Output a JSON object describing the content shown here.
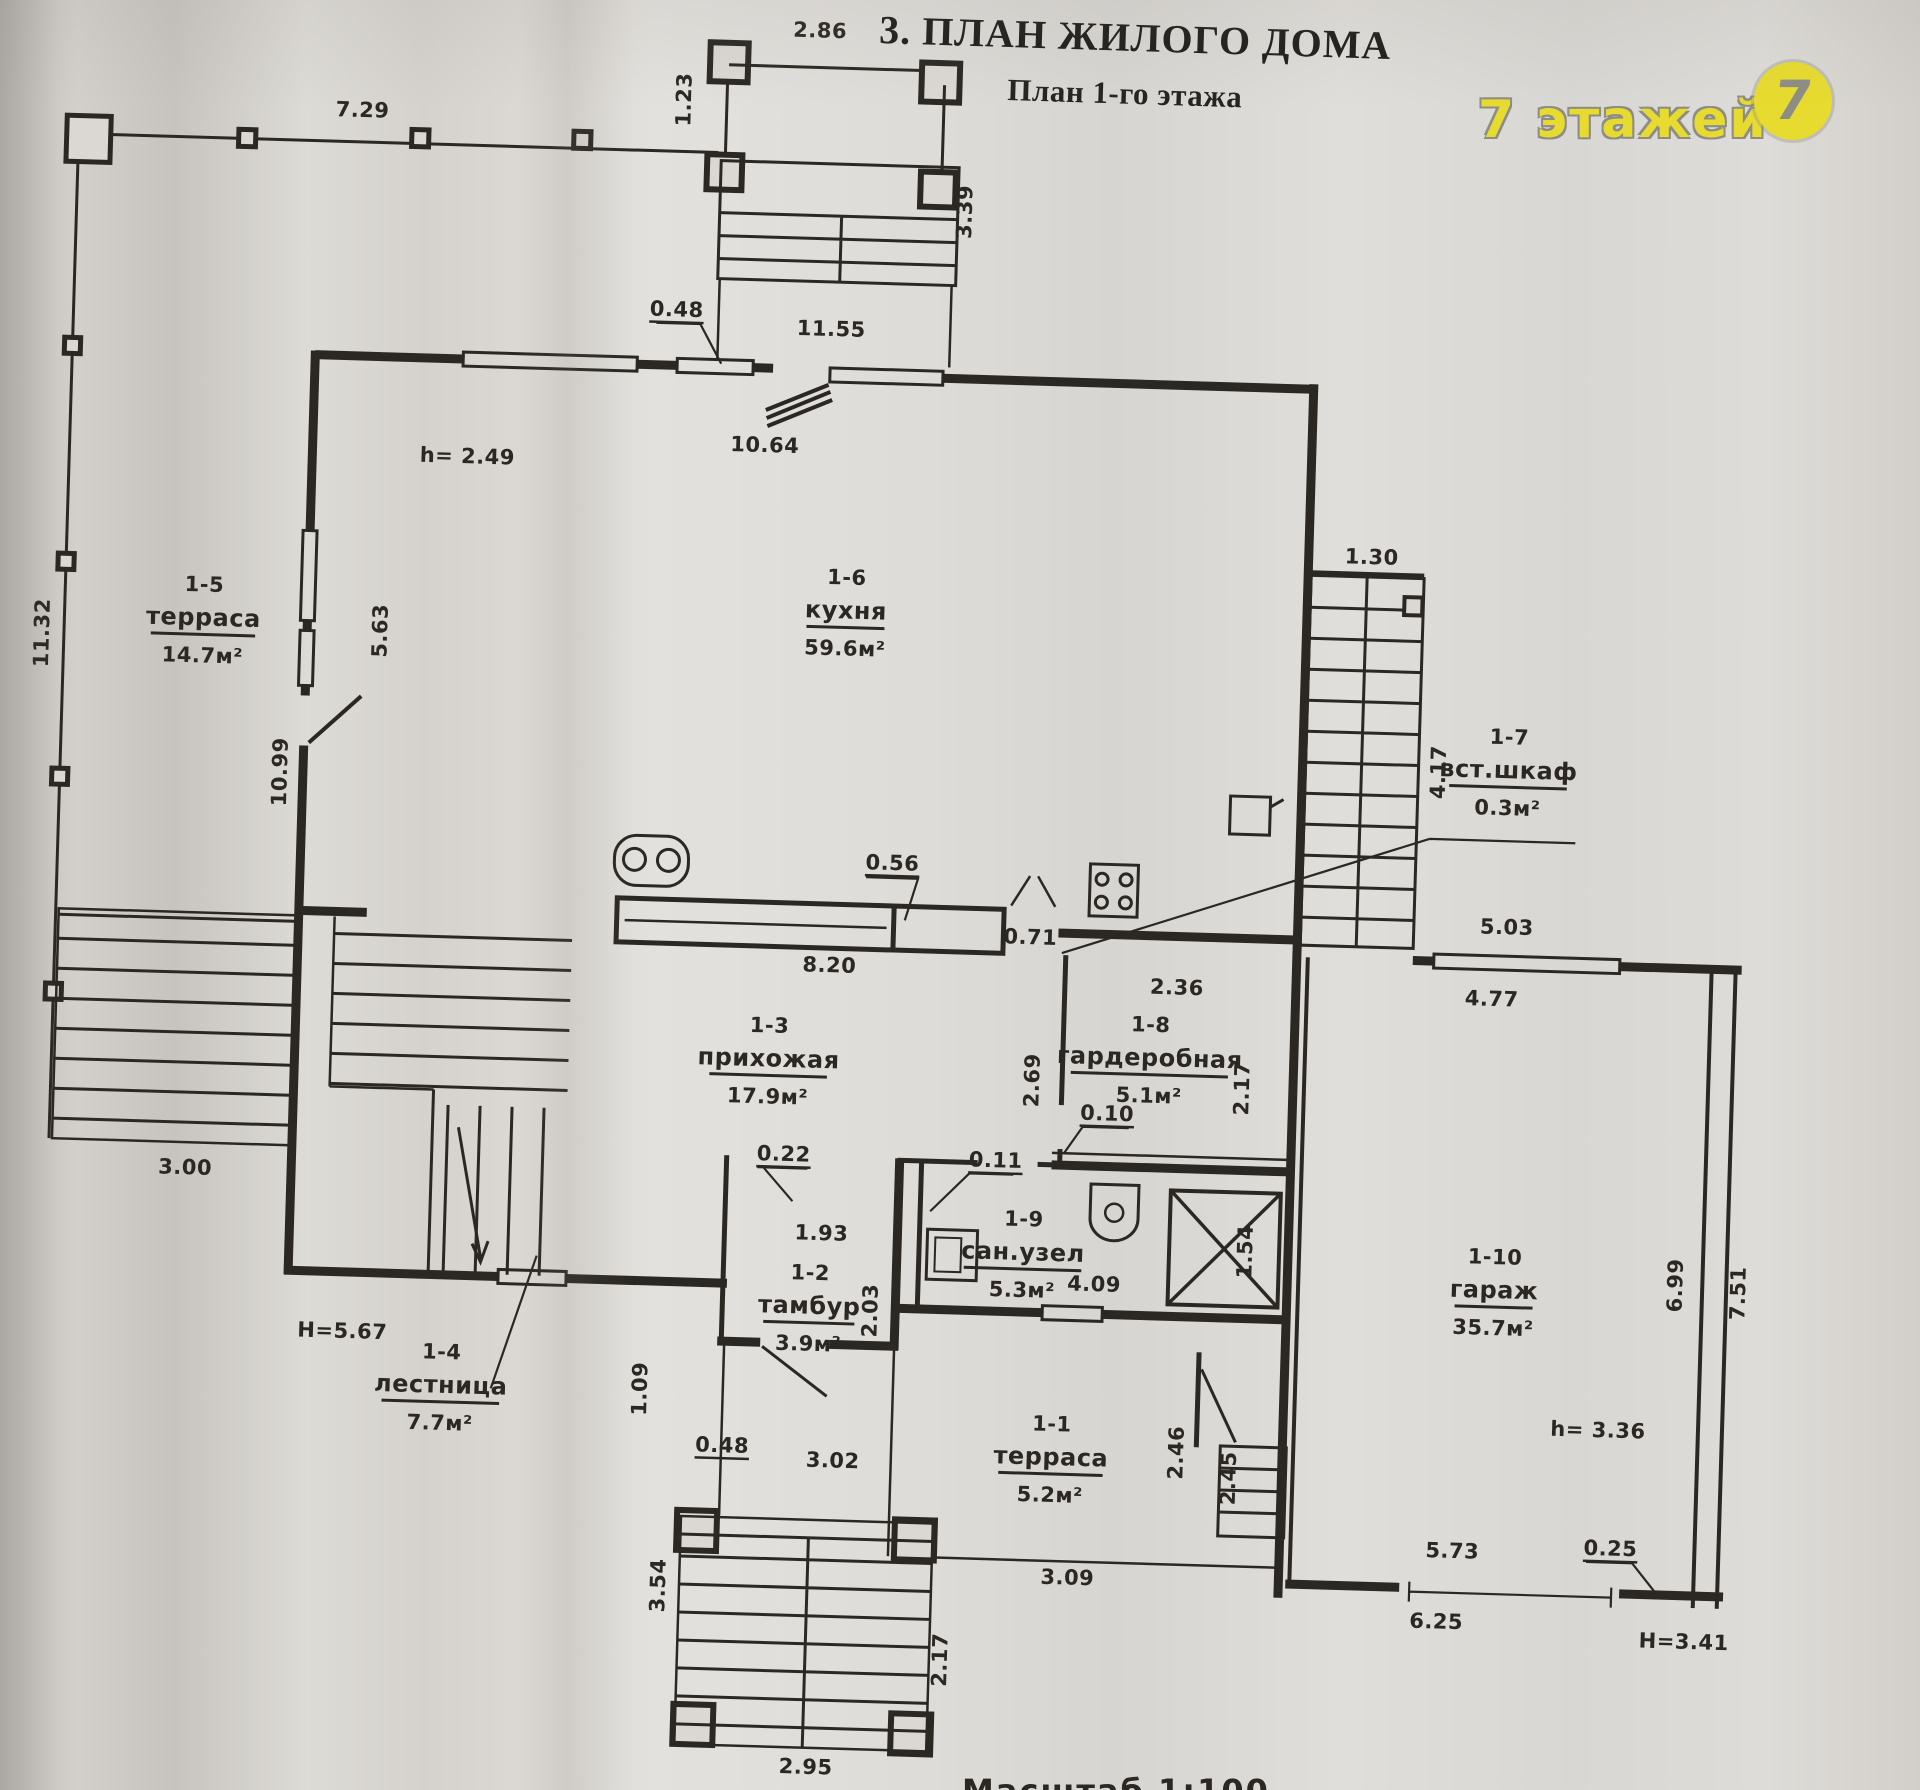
{
  "header": {
    "title": "3. ПЛАН ЖИЛОГО ДОМА",
    "subtitle": "План 1-го этажа"
  },
  "watermark": {
    "text": "7 этажей",
    "logo": "7"
  },
  "scale_note": "Масштаб 1:100",
  "colors": {
    "paper": "#dbd8d3",
    "ink": "#2b2823",
    "wm_yellow": "#e7db30",
    "wm_gray": "#8d8d86"
  },
  "rooms": [
    {
      "id": "1-5",
      "name": "терраса",
      "area": "14.7м²",
      "x": 196,
      "y": 648
    },
    {
      "id": "1-6",
      "name": "кухня",
      "area": "59.6м²",
      "x": 838,
      "y": 622
    },
    {
      "id": "1-7",
      "name": "вст.шкаф",
      "area": "0.3м²",
      "x": 1505,
      "y": 762
    },
    {
      "id": "1-3",
      "name": "прихожая",
      "area": "17.9м²",
      "x": 774,
      "y": 1072
    },
    {
      "id": "1-8",
      "name": "гардеробная",
      "area": "5.1м²",
      "x": 1155,
      "y": 1060
    },
    {
      "id": "1-9",
      "name": "сан.узел",
      "area": "5.3м²",
      "x": 1034,
      "y": 1258
    },
    {
      "id": "1-2",
      "name": "тамбур",
      "area": "3.9м²",
      "x": 822,
      "y": 1318
    },
    {
      "id": "1-4",
      "name": "лестница",
      "area": "7.7м²",
      "x": 456,
      "y": 1408
    },
    {
      "id": "1-1",
      "name": "терраса",
      "area": "5.2м²",
      "x": 1068,
      "y": 1462
    },
    {
      "id": "1-10",
      "name": "гараж",
      "area": "35.7м²",
      "x": 1506,
      "y": 1282
    }
  ],
  "dims": [
    {
      "t": "2.86",
      "x": 795,
      "y": 42
    },
    {
      "t": "1.23",
      "x": 668,
      "y": 108,
      "r": -90
    },
    {
      "t": "3.39",
      "x": 952,
      "y": 212,
      "r": -90
    },
    {
      "t": "7.29",
      "x": 340,
      "y": 135
    },
    {
      "t": "0.48",
      "x": 660,
      "y": 325,
      "u": 1
    },
    {
      "t": "11.55",
      "x": 815,
      "y": 340
    },
    {
      "t": "10.64",
      "x": 752,
      "y": 458
    },
    {
      "t": "h= 2.49",
      "x": 455,
      "y": 478
    },
    {
      "t": "11.32",
      "x": 42,
      "y": 660,
      "r": -90
    },
    {
      "t": "5.63",
      "x": 380,
      "y": 648,
      "r": -90
    },
    {
      "t": "10.99",
      "x": 284,
      "y": 792,
      "r": -90
    },
    {
      "t": "1.30",
      "x": 1362,
      "y": 552
    },
    {
      "t": "4.17",
      "x": 1442,
      "y": 758,
      "r": -90
    },
    {
      "t": "0.56",
      "x": 892,
      "y": 872,
      "u": 1
    },
    {
      "t": "0.71",
      "x": 1032,
      "y": 942
    },
    {
      "t": "5.03",
      "x": 1508,
      "y": 918
    },
    {
      "t": "4.77",
      "x": 1495,
      "y": 990
    },
    {
      "t": "8.20",
      "x": 832,
      "y": 976
    },
    {
      "t": "2.36",
      "x": 1180,
      "y": 988
    },
    {
      "t": "2.69",
      "x": 1045,
      "y": 1078,
      "r": -90
    },
    {
      "t": "2.17",
      "x": 1255,
      "y": 1080,
      "r": -90
    },
    {
      "t": "0.10",
      "x": 1114,
      "y": 1116,
      "u": 1
    },
    {
      "t": "0.22",
      "x": 792,
      "y": 1166,
      "u": 1
    },
    {
      "t": "0.11",
      "x": 1004,
      "y": 1166,
      "u": 1
    },
    {
      "t": "1.93",
      "x": 832,
      "y": 1244
    },
    {
      "t": "4.09",
      "x": 1106,
      "y": 1287
    },
    {
      "t": "1.54",
      "x": 1263,
      "y": 1243,
      "r": -90
    },
    {
      "t": "2.03",
      "x": 890,
      "y": 1313,
      "r": -90
    },
    {
      "t": "3.00",
      "x": 194,
      "y": 1197
    },
    {
      "t": "H=5.67",
      "x": 356,
      "y": 1356
    },
    {
      "t": "1.09",
      "x": 662,
      "y": 1398,
      "r": -90
    },
    {
      "t": "0.48",
      "x": 739,
      "y": 1459,
      "u": 1
    },
    {
      "t": "3.02",
      "x": 850,
      "y": 1471
    },
    {
      "t": "2.46",
      "x": 1200,
      "y": 1446,
      "r": -90
    },
    {
      "t": "2.45",
      "x": 1253,
      "y": 1470,
      "r": -90
    },
    {
      "t": "3.09",
      "x": 1088,
      "y": 1581
    },
    {
      "t": "3.54",
      "x": 686,
      "y": 1594,
      "r": -90
    },
    {
      "t": "2.17",
      "x": 970,
      "y": 1660,
      "r": -90
    },
    {
      "t": "2.95",
      "x": 832,
      "y": 1778
    },
    {
      "t": "6.99",
      "x": 1694,
      "y": 1264,
      "r": -90
    },
    {
      "t": "7.51",
      "x": 1757,
      "y": 1270,
      "r": -90
    },
    {
      "t": "h= 3.36",
      "x": 1614,
      "y": 1418
    },
    {
      "t": "5.73",
      "x": 1472,
      "y": 1543
    },
    {
      "t": "0.25",
      "x": 1630,
      "y": 1536,
      "u": 1
    },
    {
      "t": "6.25",
      "x": 1458,
      "y": 1614
    },
    {
      "t": "H=3.41",
      "x": 1706,
      "y": 1627
    }
  ]
}
